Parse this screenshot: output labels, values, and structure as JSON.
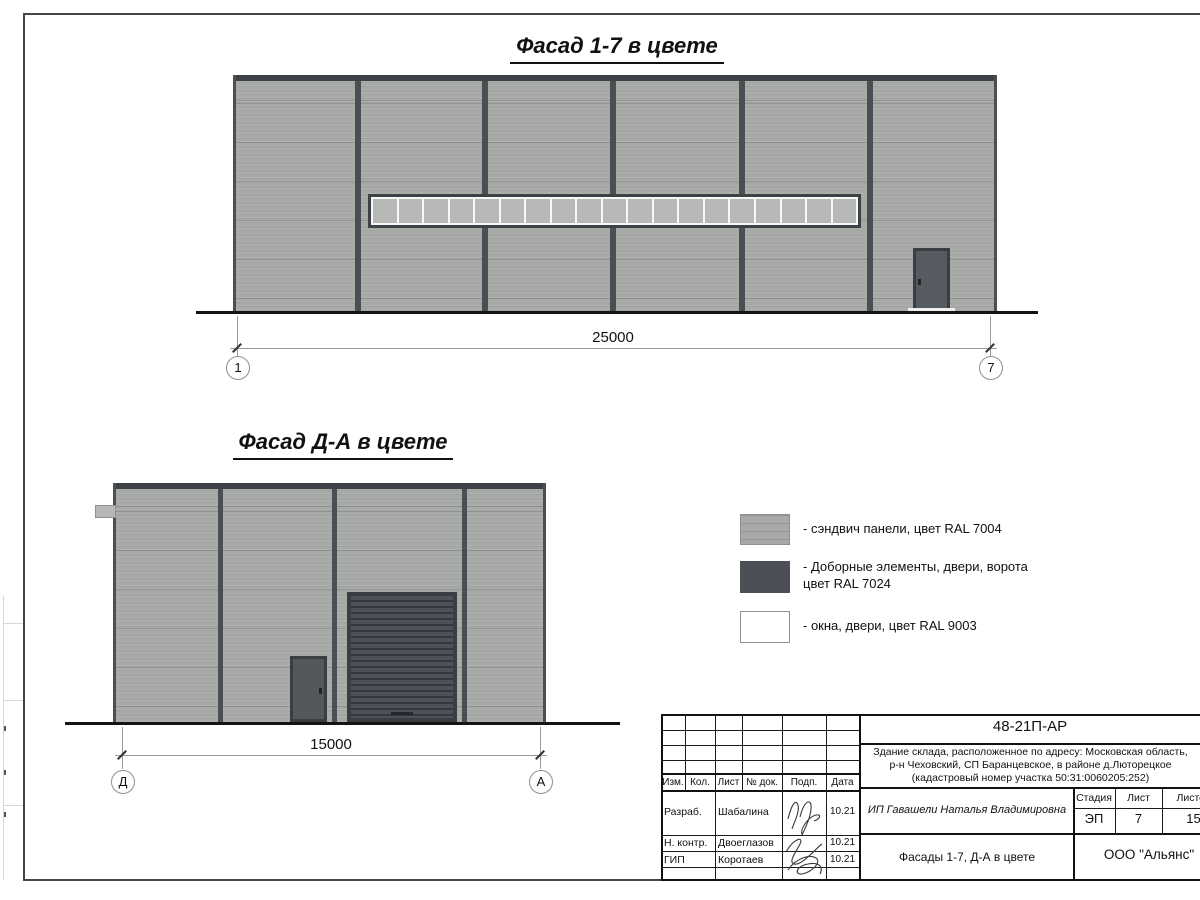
{
  "drawing": {
    "facade1": {
      "title": "Фасад 1-7 в цвете",
      "dimension": "25000",
      "axis_left": "1",
      "axis_right": "7",
      "window_pane_count": 19
    },
    "facade2": {
      "title": "Фасад Д-А в цвете",
      "dimension": "15000",
      "axis_left": "Д",
      "axis_right": "А"
    },
    "legend": {
      "items": [
        {
          "label": "- сэндвич панели, цвет RAL 7004",
          "ral": "RAL 7004",
          "color": "#a8aaa8"
        },
        {
          "label_line1": "- Доборные элементы, двери, ворота",
          "label_line2": "цвет RAL 7024",
          "ral": "RAL 7024",
          "color": "#4c5056"
        },
        {
          "label": "- окна, двери, цвет RAL 9003",
          "ral": "RAL 9003",
          "color": "#ffffff"
        }
      ]
    },
    "titleblock": {
      "code": "48-21П-АР",
      "description_line1": "Здание склада, расположенное по адресу: Московская область,",
      "description_line2": "р-н Чеховский, СП Баранцевское, в районе д.Люторецкое",
      "description_line3": "(кадастровый номер участка 50:31:0060205:252)",
      "header": [
        "Изм.",
        "Кол.",
        "Лист",
        "№ док.",
        "Подп.",
        "Дата"
      ],
      "rows": [
        {
          "role": "Разраб.",
          "name": "Шабалина",
          "date": "10.21"
        },
        {
          "role": "Н. контр.",
          "name": "Двоеглазов",
          "date": "10.21"
        },
        {
          "role": "ГИП",
          "name": "Коротаев",
          "date": "10.21"
        }
      ],
      "client": "ИП Гавашели Наталья Владимировна",
      "stage_header": [
        "Стадия",
        "Лист",
        "Листов"
      ],
      "stage": "ЭП",
      "sheet": "7",
      "sheets": "15",
      "doc_title": "Фасады 1-7, Д-А в цвете",
      "company": "ООО \"Альянс\""
    }
  }
}
